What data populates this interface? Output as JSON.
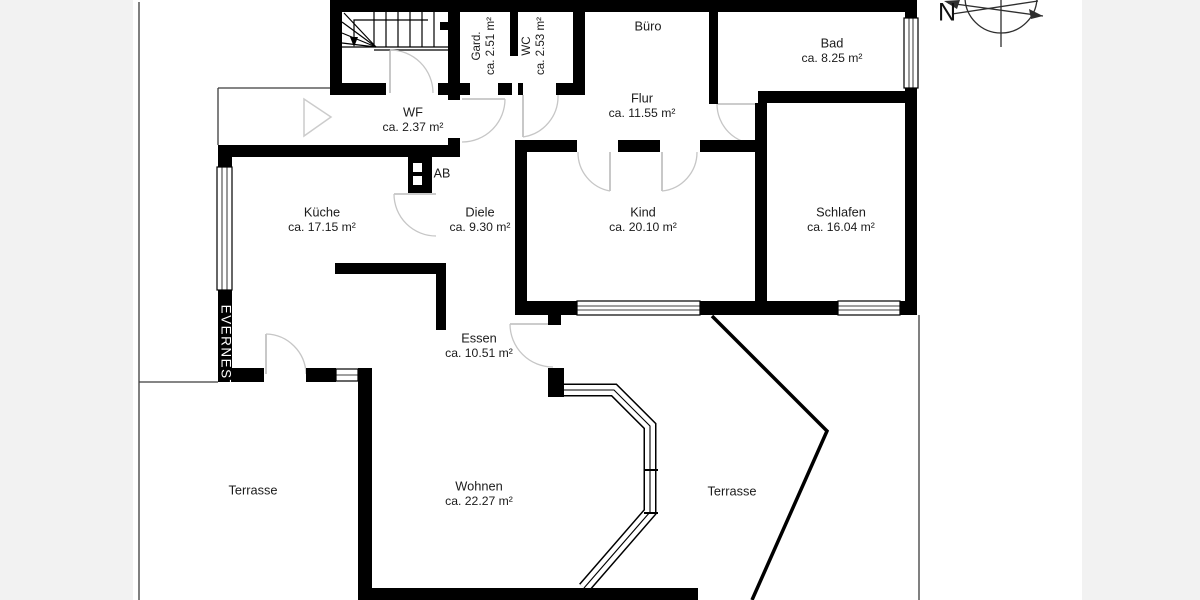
{
  "title": "Grundriss (floor plan)",
  "compass": {
    "label": "N"
  },
  "watermark": {
    "text": "EVERNEST"
  },
  "shaft": {
    "label": "AB"
  },
  "colors": {
    "walls": "#000000",
    "background": "#ffffff",
    "margin_band": "#f2f2f2",
    "door_arc": "#c6c6c6"
  },
  "rooms": [
    {
      "id": "gard",
      "name": "Gard.",
      "area": "ca. 2.51 m²",
      "orientation": "vertical",
      "x": 484,
      "y": 46
    },
    {
      "id": "wc",
      "name": "WC",
      "area": "ca. 2.53 m²",
      "orientation": "vertical",
      "x": 534,
      "y": 46
    },
    {
      "id": "buero",
      "name": "Büro",
      "area": "",
      "orientation": "horizontal",
      "x": 648,
      "y": 27
    },
    {
      "id": "bad",
      "name": "Bad",
      "area": "ca. 8.25 m²",
      "orientation": "horizontal",
      "x": 832,
      "y": 44
    },
    {
      "id": "wf",
      "name": "WF",
      "area": "ca. 2.37 m²",
      "orientation": "horizontal",
      "x": 413,
      "y": 113
    },
    {
      "id": "flur",
      "name": "Flur",
      "area": "ca. 11.55 m²",
      "orientation": "horizontal",
      "x": 642,
      "y": 99
    },
    {
      "id": "kueche",
      "name": "Küche",
      "area": "ca. 17.15 m²",
      "orientation": "horizontal",
      "x": 322,
      "y": 213
    },
    {
      "id": "diele",
      "name": "Diele",
      "area": "ca. 9.30 m²",
      "orientation": "horizontal",
      "x": 480,
      "y": 213
    },
    {
      "id": "kind",
      "name": "Kind",
      "area": "ca. 20.10 m²",
      "orientation": "horizontal",
      "x": 643,
      "y": 213
    },
    {
      "id": "schlafen",
      "name": "Schlafen",
      "area": "ca. 16.04 m²",
      "orientation": "horizontal",
      "x": 841,
      "y": 213
    },
    {
      "id": "essen",
      "name": "Essen",
      "area": "ca. 10.51 m²",
      "orientation": "horizontal",
      "x": 479,
      "y": 339
    },
    {
      "id": "wohnen",
      "name": "Wohnen",
      "area": "ca. 22.27 m²",
      "orientation": "horizontal",
      "x": 479,
      "y": 487
    },
    {
      "id": "terrasse-west",
      "name": "Terrasse",
      "area": "",
      "orientation": "horizontal",
      "x": 253,
      "y": 491
    },
    {
      "id": "terrasse-east",
      "name": "Terrasse",
      "area": "",
      "orientation": "horizontal",
      "x": 732,
      "y": 492
    }
  ]
}
